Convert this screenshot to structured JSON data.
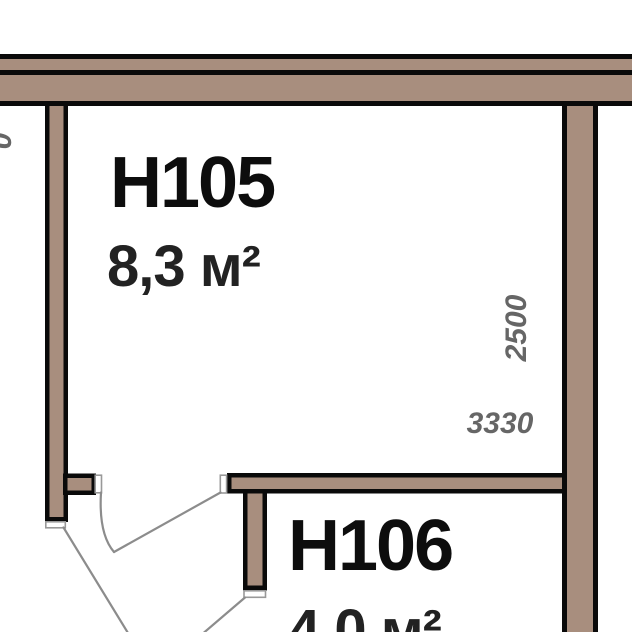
{
  "plan": {
    "type": "floor-plan",
    "rooms": [
      {
        "label": "H105",
        "area": "8,3 м²"
      },
      {
        "label": "H106",
        "area": "4,0 м²"
      }
    ],
    "dimensions": {
      "h105_depth_mm": "2500",
      "h105_width_mm": "3330",
      "left_edge_partial_digit": "0"
    },
    "colors": {
      "wall_fill": "#a88e7e",
      "wall_outline": "#0a0a0a",
      "door_jamb_outline": "#999999",
      "door_swing_line": "#8c8c8c",
      "room_label_text": "#0d0d0d",
      "area_label_text": "#222222",
      "dimension_text": "#666666",
      "background": "#ffffff"
    }
  }
}
